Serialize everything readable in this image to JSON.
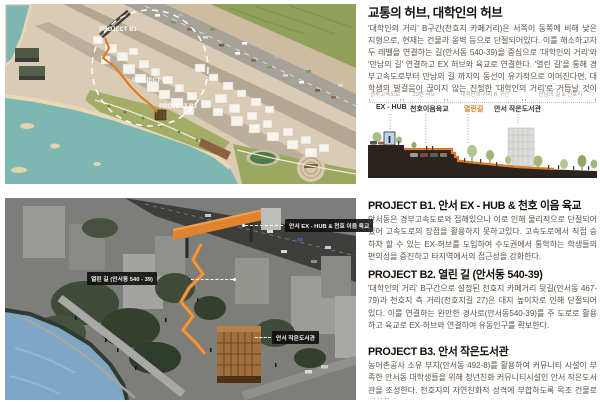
{
  "intro": {
    "title": "교통의 허브, 대학인의 허브",
    "body": "'대학인의 거리' B구간(천호지 카페거리)은 서쪽이 동쪽에 비해 낮은 지형으로, 현재는 건물과 옹벽 등으로 단절되어있다. 이를 해소하고자 두 레벨을 연결하는 길(안서동 540-39)을 중심으로 '대학인의 거리'와 '만남의 길' 연결하고 EX 허브와 육교로 연결한다. '열린 길'을 통해 경부고속도로부터 만남의 길 까지의 동선이 유기적으로 이어진다면, 대학생의 발걸음이 끊이지 않는 진정한 '대학인의 거리'로 거듭날 것이다."
  },
  "map": {
    "labels": [
      "PROJECT B1",
      "PROJECT B2",
      "PROJECT B3"
    ]
  },
  "section_figure": {
    "zones": [
      "경부고속도로",
      "23번 국도",
      "대학인의 거리 B 구간",
      "만남의 길 & 천호지"
    ],
    "features": [
      "EX - HUB",
      "천호이음육교",
      "열린길",
      "안서 작은도서관"
    ]
  },
  "render": {
    "callouts": [
      "안서 EX - HUB & 천호 이음 육교",
      "열린 길 (안서동 540 - 39)",
      "안서 작은도서관"
    ]
  },
  "projects": [
    {
      "heading": "PROJECT B1. 안서 EX - HUB & 천호 이음 육교",
      "body": "안서동은 경부고속도로와 접해있으나 이로 인해 물리적으로 단절되어있어 고속도로의 장점을 활용하지 못하고있다. 고속도로에서 직접 승하차 할 수 있는 EX-허브를 도입하여 수도권에서 통학하는 학생들의 편의성을 증진하고 타지역에서의 접근성을 강화한다."
    },
    {
      "heading": "PROJECT B2. 열린 길 (안서동 540-39)",
      "body": "'대학인의 거리' B구간으로 설정된 천호지 카페거리 뒷길(안서동 467-79)과 천호지 측 거리(천호지길 27)은 대지 높이차로 인해 단절되어 있다. 이를 연결하는 완만한 경사로(안서동540-39)를 주 도로로 활용하고 육교로 EX-허브와 연결하여 유동인구를 확보한다."
    },
    {
      "heading": "PROJECT B3. 안서 작은도서관",
      "body": "농어촌공사 소유 부지(안서동 492-8)를 활용하여 커뮤니티 시설이 부족한 안서동 대학생들을 위해 청년친화 커뮤니티시설인 안서 작은도서관을 조성한다. 천호지의 자연친화적 성격에 부합하도록 목조 건물로 계획한다."
    }
  ],
  "colors": {
    "accent_orange": "#E07A2A",
    "water_teal": "#7DB7B2",
    "ink": "#141008",
    "body_text": "#5C5145",
    "muted_label": "#A49D92"
  }
}
